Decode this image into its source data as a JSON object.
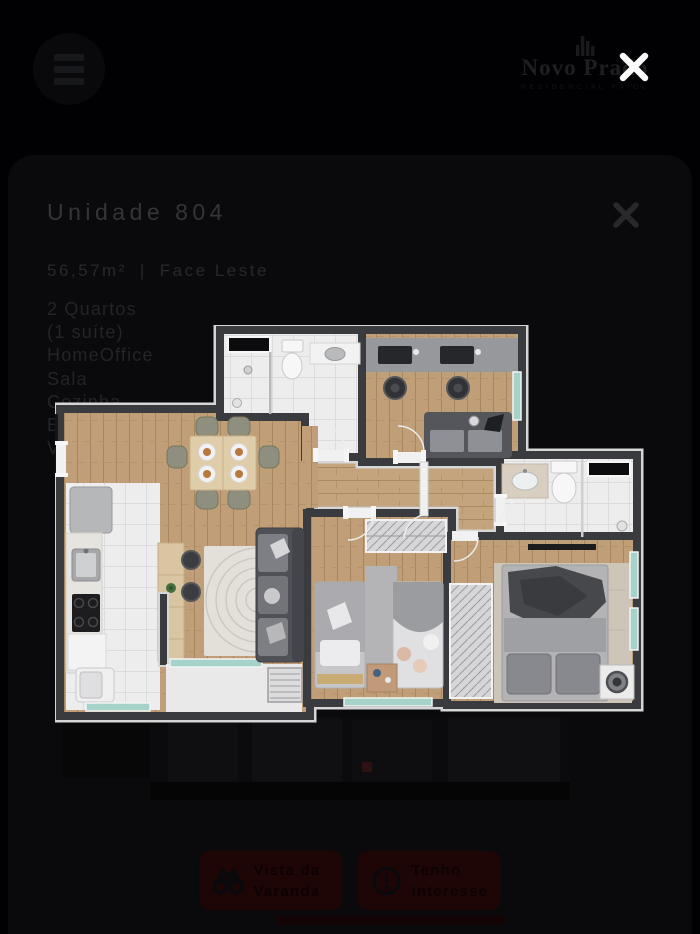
{
  "header": {
    "logo_name": "Novo Prado",
    "logo_tagline": "RESIDENCIAL PAIOL"
  },
  "modal": {
    "title": "Unidade 804",
    "area": "56,57m²",
    "separator": "|",
    "orientation": "Face Leste",
    "features": [
      "2 Quartos",
      "(1 suíte)",
      "HomeOffice",
      "Sala",
      "Cozinha",
      "B",
      "V"
    ],
    "actions": [
      {
        "icon": "binoculars-icon",
        "line1": "Vista da",
        "line2": "Varanda"
      },
      {
        "icon": "exclamation-icon",
        "line1": "Tenho",
        "line2": "interesse"
      }
    ]
  },
  "colors": {
    "background": "#010103",
    "card": "#0a0a0c",
    "wall": "#3a3b3e",
    "wood_floor": "#c09f78",
    "tile_floor": "#ededee",
    "glass_accent": "#a5d2c9",
    "button_background": "#1e0607",
    "close_white": "#fbfbfc"
  }
}
